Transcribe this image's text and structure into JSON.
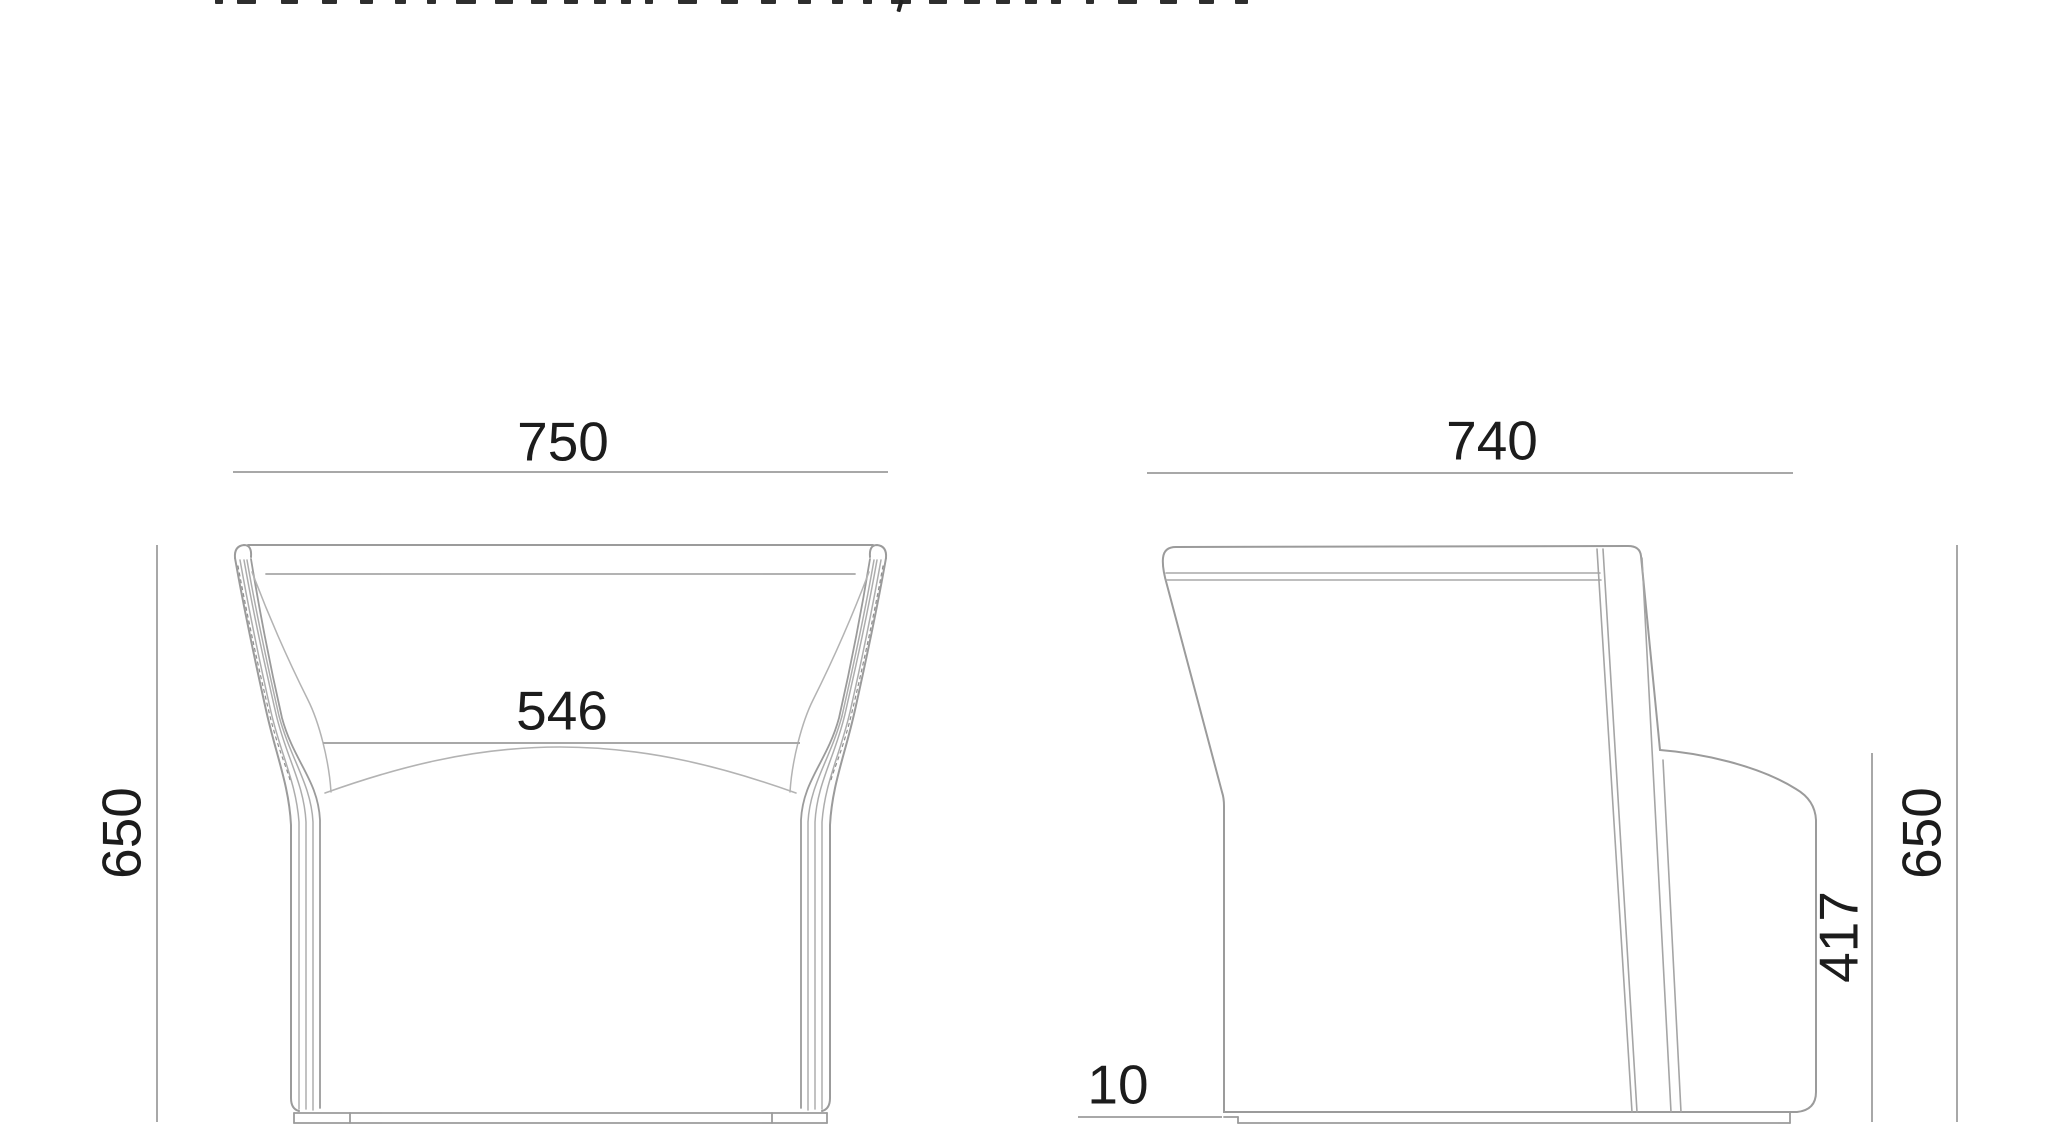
{
  "dimensions": {
    "front_width": "750",
    "front_seat_width": "546",
    "front_height": "650",
    "side_depth": "740",
    "side_height": "650",
    "side_arm_height": "417",
    "side_base_height": "10"
  },
  "colors": {
    "background": "#ffffff",
    "outline": "#9b9b9b",
    "detail_line": "#b0b0b0",
    "dimension_line": "#a8a8a8",
    "label_text": "#1c1c1c",
    "header_fragment": "#2e2e2e"
  }
}
